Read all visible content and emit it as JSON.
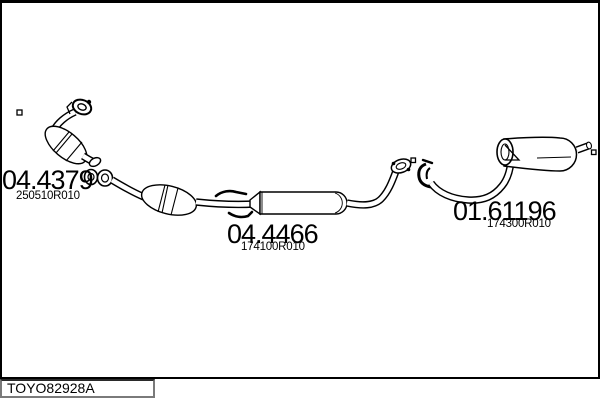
{
  "window": {
    "background": "#ffffff",
    "frame_color": "#000000",
    "line_color": "#000000"
  },
  "footer": {
    "catalog_code": "TOYO82928A"
  },
  "parts": [
    {
      "code": "04.4379",
      "ref": "250510R010"
    },
    {
      "code": "04.4466",
      "ref": "174100R010"
    },
    {
      "code": "01.61196",
      "ref": "174300R010"
    }
  ]
}
